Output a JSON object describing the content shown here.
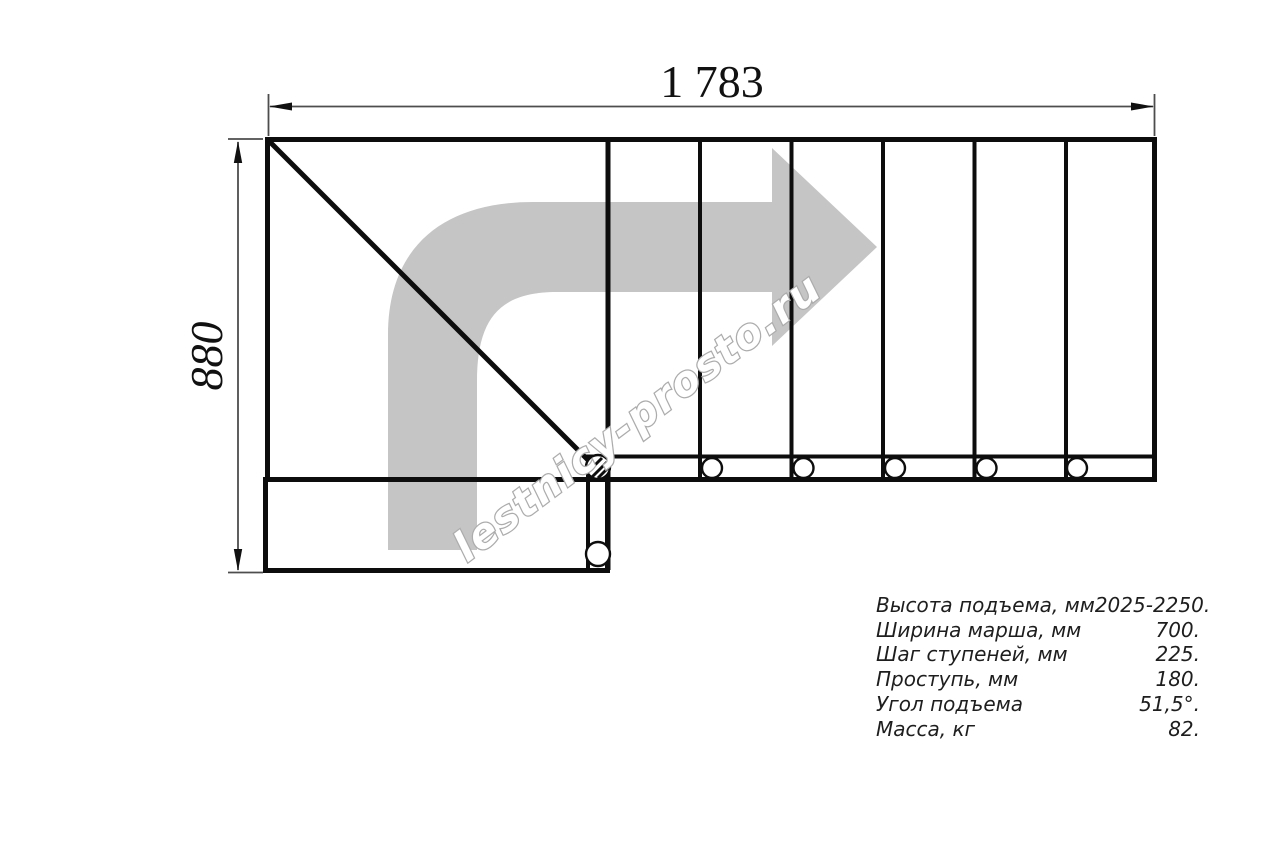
{
  "drawing": {
    "title": "staircase-top-view-plan",
    "top_dimension_label": "1 783",
    "left_dimension_label": "880",
    "watermark_text": "lestnicy-prosto.ru",
    "colors": {
      "line": "#0d0d0d",
      "dimension_line": "#4d4d4d",
      "arrow_fill": "#c5c5c5",
      "watermark_stroke": "#acacac",
      "watermark_fill": "#ffffff"
    }
  },
  "specs": {
    "rows": [
      {
        "label": "Высота подъема, мм",
        "value": "2025-2250."
      },
      {
        "label": "Ширина марша, мм",
        "value": "700."
      },
      {
        "label": "Шаг ступеней, мм",
        "value": "225."
      },
      {
        "label": "Проступь, мм",
        "value": "180."
      },
      {
        "label": "Угол подъема",
        "value": "51,5°."
      },
      {
        "label": "Масса, кг",
        "value": "82."
      }
    ]
  }
}
